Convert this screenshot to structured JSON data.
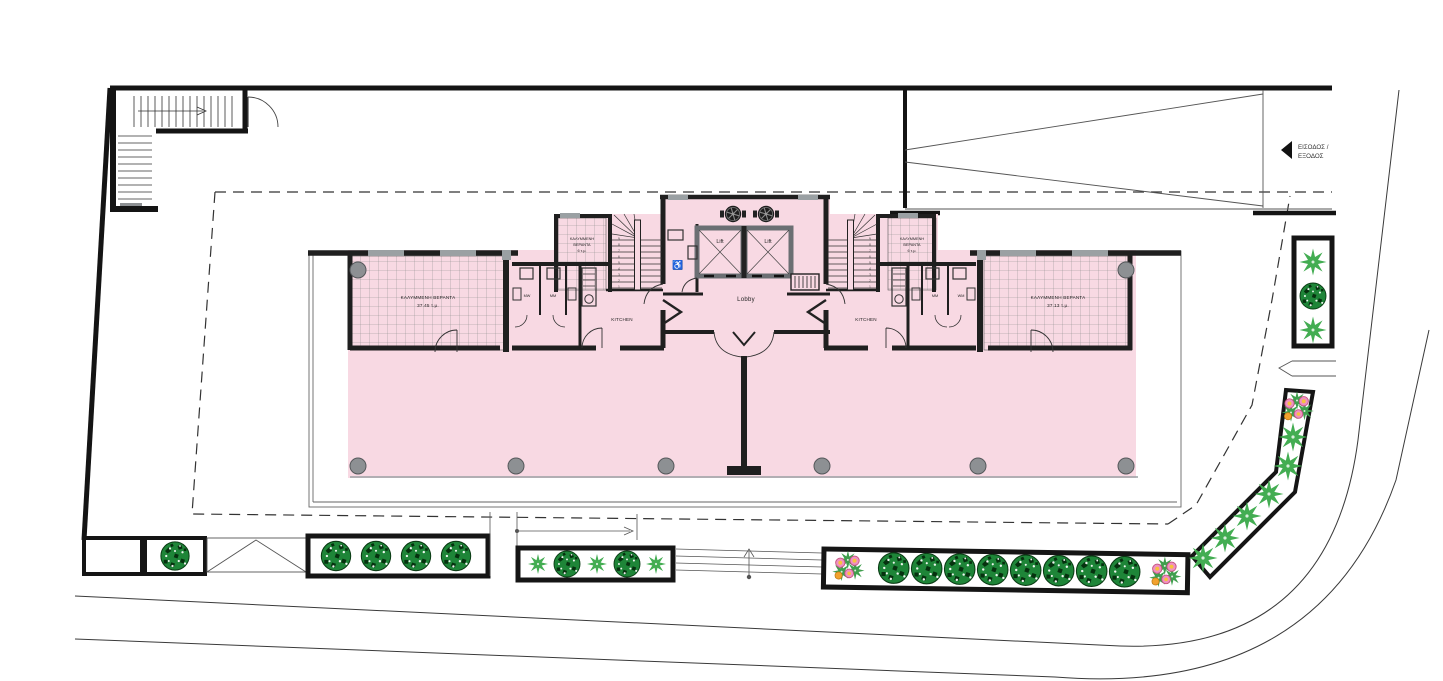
{
  "labels": {
    "lobby": "Lobby",
    "lift_left": "Lift",
    "lift_right": "Lift",
    "kitchen_left": "KITCHEN",
    "kitchen_right": "KITCHEN",
    "wc": {
      "left_1": "MW",
      "left_2": "MM",
      "right_1": "MM",
      "right_2": "WM"
    },
    "veranda_left": {
      "line1": "ΚΑΛΥΜΜΕΝΗ ΒΕΡΑΝΤΑ",
      "line2": "37.45 τ.μ."
    },
    "veranda_right": {
      "line1": "ΚΑΛΥΜΜΕΝΗ ΒΕΡΑΝΤΑ",
      "line2": "37.13 τ.μ."
    },
    "small_veranda": {
      "line1": "ΚΑΛΥΜΜΕΝΗ",
      "line2": "ΒΕΡΑΝΤΑ",
      "line3": "6 τ.μ."
    },
    "entrance_exit": {
      "line1": "ΕΙΣΟΔΟΣ /",
      "line2": "ΕΞΟΔΟΣ"
    },
    "wheelchair_icon": "♿"
  },
  "stair_numbers": [
    "9",
    "8",
    "7",
    "6",
    "5",
    "4",
    "3",
    "2",
    "1"
  ],
  "colors": {
    "floor_pink": "#f8d9e3",
    "wall_dark": "#1f1f1f",
    "window_gray": "#9aa0a3",
    "column_gray": "#8d9093",
    "tree_green": "#1e8538",
    "shrub_green": "#43ad52",
    "flower_pink": "#ef91c2",
    "flower_orange": "#f2a22e",
    "hatch_gray": "#8b8b8b"
  }
}
